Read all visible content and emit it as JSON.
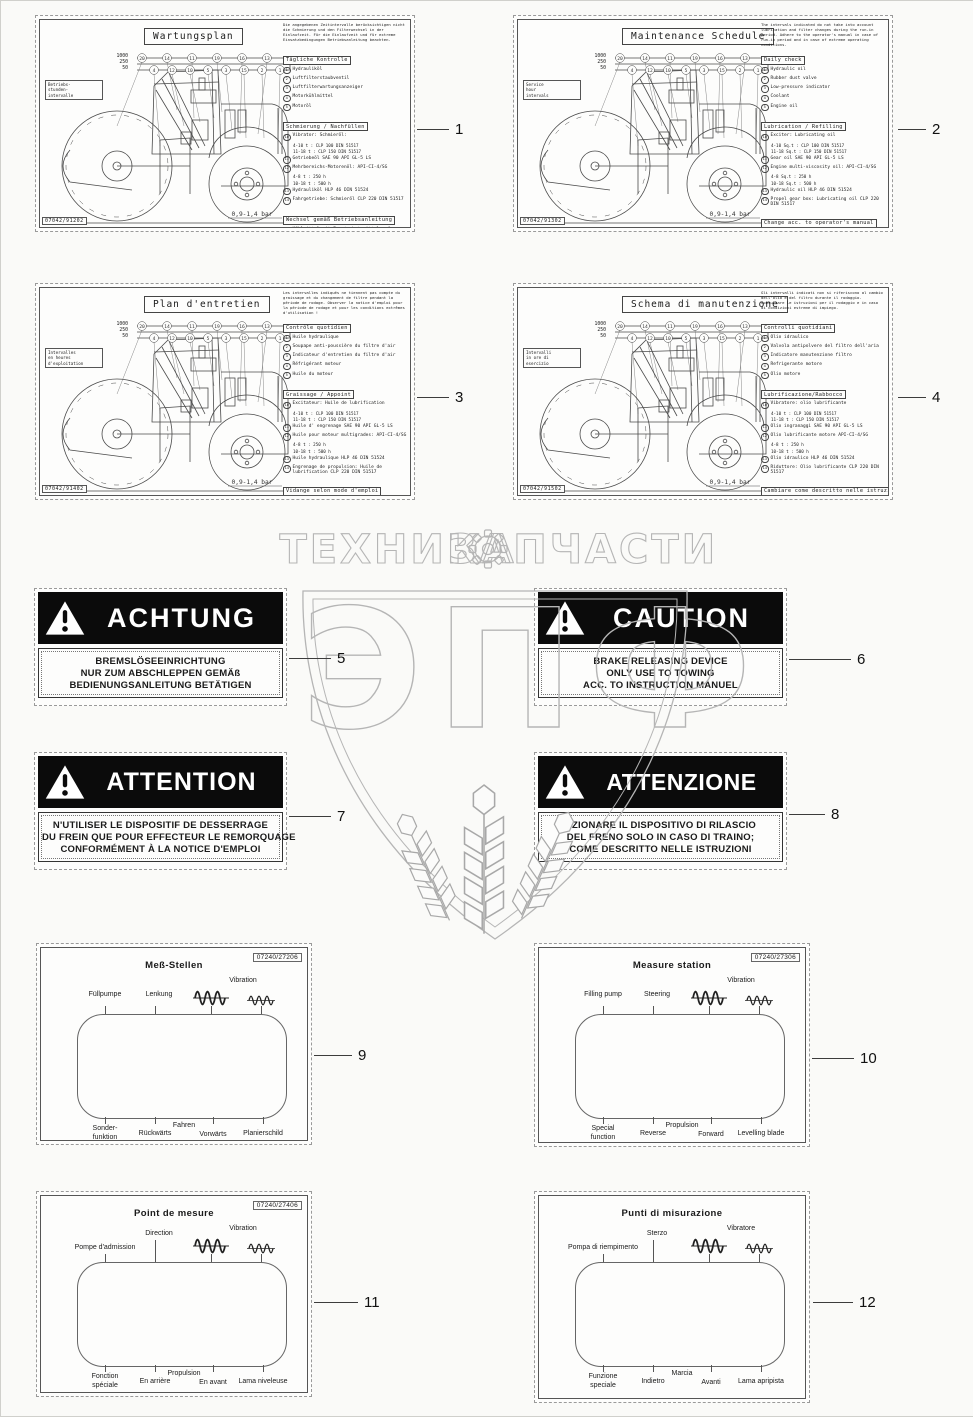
{
  "watermark": {
    "left_word": "ТЕХНИКА",
    "right_word": "ЗАПЧАСТИ",
    "monogram": "ЭПФ",
    "stroke_color": "#b5b5b5"
  },
  "machine": {
    "pressure": "0,9-1,4 bar",
    "hours": [
      "1000",
      "250",
      "50"
    ],
    "top_nums": [
      "20",
      "14",
      "11",
      "19",
      "16",
      "13"
    ],
    "bot_nums": [
      "4",
      "12",
      "10",
      "5",
      "3",
      "15",
      "2",
      "1"
    ]
  },
  "maintenance_labels": [
    {
      "callout": "1",
      "title": "Wartungsplan",
      "code": "07042/91202",
      "hours_label": "Betriebs-\nstunden-\nintervalle",
      "note": "Die angegebenen Zeitintervalle berücksichtigen nicht die Schmierung und den Filterwechsel in der Einlaufzeit. Für die Einlaufzeit und für extreme Einsatzbedingungen Betriebsanleitung beachten.",
      "sections": [
        {
          "heading": "Tägliche Kontrolle",
          "items": [
            {
              "n": "1",
              "t": "Hydrauliköl"
            },
            {
              "n": "2",
              "t": "Luftfilterstaubventil"
            },
            {
              "n": "3",
              "t": "Luftfilterwartungsanzeiger"
            },
            {
              "n": "4",
              "t": "Motorkühlmittel"
            },
            {
              "n": "5",
              "t": "Motoröl"
            }
          ]
        },
        {
          "heading": "Schmierung / Nachfüllen",
          "items": [
            {
              "n": "10",
              "t": "Vibrator: Schmieröl:",
              "sub": [
                "4-10 t : CLP 100 DIN 51517",
                "11-18 t : CLP 150 DIN 51517"
              ]
            },
            {
              "n": "11",
              "t": "Getriebeöl SAE 90 API GL-5 LS"
            },
            {
              "n": "12",
              "t": "Mehrbereichs-Motorenöl: API-CI-4/SG",
              "sub": [
                "4-8 t : 250 h",
                "10-18 t : 500 h"
              ]
            },
            {
              "n": "13",
              "t": "Hydrauliköl HLP 46 DIN 51524"
            },
            {
              "n": "14",
              "t": "Fahrgetriebe: Schmieröl CLP 220 DIN 51517"
            }
          ]
        },
        {
          "heading": "Wechsel gemäß Betriebsanleitung",
          "items": [
            {
              "n": "15",
              "t": "Kühlmittel mit Frostschutzmittel auf Äthylenglykolbasis"
            },
            {
              "n": "16",
              "t": "Hauptluftfilterpatrone und Sicherheitsluftfilterpatrone"
            },
            {
              "n": "17",
              "t": "Kraftstofffilter"
            },
            {
              "n": "18",
              "t": "Kraftstoffleitungsfilter"
            },
            {
              "n": "19",
              "t": "Motorölfilter"
            },
            {
              "n": "20",
              "t": "Hydraulikölfilter"
            }
          ]
        }
      ]
    },
    {
      "callout": "2",
      "title": "Maintenance Schedule",
      "code": "07042/91302",
      "hours_label": "Service\nhour\nintervals",
      "note": "The intervals indicated do not take into account lubrication and filter changes during the run-in period. Adhere to the operator's manual in case of run-in period and in case of extreme operating conditions.",
      "sections": [
        {
          "heading": "Daily check",
          "items": [
            {
              "n": "1",
              "t": "Hydraulic oil"
            },
            {
              "n": "2",
              "t": "Rubber dust valve"
            },
            {
              "n": "3",
              "t": "Low-pressure indicator"
            },
            {
              "n": "4",
              "t": "Coolant"
            },
            {
              "n": "5",
              "t": "Engine oil"
            }
          ]
        },
        {
          "heading": "Lubrication / Refilling",
          "items": [
            {
              "n": "10",
              "t": "Exciter: Lubricating oil",
              "sub": [
                "4-10 Sq.t : CLP 100 DIN 51517",
                "11-18 Sq.t : CLP 150 DIN 51517"
              ]
            },
            {
              "n": "11",
              "t": "Gear oil SAE 90 API GL-5 LS"
            },
            {
              "n": "12",
              "t": "Engine multi-viscosity oil: API-CI-4/SG",
              "sub": [
                "4-8 Sq.t : 250 h",
                "10-18 Sq.t : 500 h"
              ]
            },
            {
              "n": "13",
              "t": "Hydraulic oil HLP 46 DIN 51524"
            },
            {
              "n": "14",
              "t": "Propel gear box: Lubricating oil CLP 220 DIN 51517"
            }
          ]
        },
        {
          "heading": "Change acc. to operator's manual",
          "items": [
            {
              "n": "15",
              "t": "Coolant with ethylene-glycol-based antifreeze"
            },
            {
              "n": "16",
              "t": "Primary air cleaner element and secondary air cleaner element"
            },
            {
              "n": "17",
              "t": "Fuel filter"
            },
            {
              "n": "18",
              "t": "Fuel pipe filter"
            },
            {
              "n": "19",
              "t": "Engine oil filter"
            },
            {
              "n": "20",
              "t": "Hydraulic oil filter"
            }
          ]
        }
      ]
    },
    {
      "callout": "3",
      "title": "Plan d'entretien",
      "code": "07042/91402",
      "hours_label": "Intervalles\nen heures\nd'exploitation",
      "note": "Les intervalles indiqués ne tiennent pas compte du graissage et du changement de filtre pendant la période de rodage. Observer la notice d'emploi pour la période de rodage et pour les conditions extrêmes d'utilisation !",
      "sections": [
        {
          "heading": "Contrôle quotidien",
          "items": [
            {
              "n": "1",
              "t": "Huile hydraulique"
            },
            {
              "n": "2",
              "t": "Soupape anti-poussière du filtre d'air"
            },
            {
              "n": "3",
              "t": "Indicateur d'entretien du filtre d'air"
            },
            {
              "n": "4",
              "t": "Réfrigérant moteur"
            },
            {
              "n": "5",
              "t": "Huile du moteur"
            }
          ]
        },
        {
          "heading": "Graissage / Appoint",
          "items": [
            {
              "n": "10",
              "t": "Excitateur: Huile de lubrification",
              "sub": [
                "4-10 t : CLP 100 DIN 51517",
                "11-18 t : CLP 150 DIN 51517"
              ]
            },
            {
              "n": "11",
              "t": "Huile d' engrenage SAE 90 API GL-5 LS"
            },
            {
              "n": "12",
              "t": "Huile pour moteur multigrades: API-CI-4/SG",
              "sub": [
                "4-8 t : 250 h",
                "10-18 t : 500 h"
              ]
            },
            {
              "n": "13",
              "t": "Huile hydraulique HLP 46 DIN 51524"
            },
            {
              "n": "14",
              "t": "Engrenage de propulsion: Huile de lubrification CLP 220 DIN 51517"
            }
          ]
        },
        {
          "heading": "Vidange selon mode d'emploi",
          "items": [
            {
              "n": "15",
              "t": "Réfrigérant avec antigel à base de glycol d'éthylène"
            },
            {
              "n": "16",
              "t": "Cartouche du filtre d'air principal et cartouche du filtre d'air de sécurité"
            },
            {
              "n": "17",
              "t": "Filtre du carburant"
            },
            {
              "n": "18",
              "t": "Filtre de la conduite de carburant"
            },
            {
              "n": "19",
              "t": "Filtre d'huile du moteur"
            },
            {
              "n": "20",
              "t": "Filtre d'huile hydraulique"
            }
          ]
        }
      ]
    },
    {
      "callout": "4",
      "title": "Schema di manutenzione",
      "code": "07042/91502",
      "hours_label": "Intervalli\nin ore di\nesercizio",
      "note": "Gli intervalli indicati non si riferiscono al cambio dell'olio e del filtro durante il rodaggio. Consultare le istruzioni per il rodaggio e in caso di condizioni estreme di impiego.",
      "sections": [
        {
          "heading": "Controlli quotidiani",
          "items": [
            {
              "n": "1",
              "t": "Olio idraulico"
            },
            {
              "n": "2",
              "t": "Valvola antipolvere del filtro dell'aria"
            },
            {
              "n": "3",
              "t": "Indicatore manutenzione filtro"
            },
            {
              "n": "4",
              "t": "Refrigerante motore"
            },
            {
              "n": "5",
              "t": "Olio motore"
            }
          ]
        },
        {
          "heading": "Lubrificazione/Rabbocco",
          "items": [
            {
              "n": "10",
              "t": "Vibratore: olio lubrificante",
              "sub": [
                "4-10 t : CLP 100 DIN 51517",
                "11-18 t : CLP 150 DIN 51517"
              ]
            },
            {
              "n": "11",
              "t": "Olio ingranaggi SAE 90 API GL-5 LS"
            },
            {
              "n": "12",
              "t": "Olio lubrificante motore API-CI-4/SG",
              "sub": [
                "4-8 t : 250 h",
                "10-18 t : 500 h"
              ]
            },
            {
              "n": "13",
              "t": "Olio idraulico HLP 46 DIN 51524"
            },
            {
              "n": "14",
              "t": "Riduttore: Olio lubrificante CLP 220 DIN 51517"
            }
          ]
        },
        {
          "heading": "Cambiare come descritto nelle istruzioni",
          "items": [
            {
              "n": "15",
              "t": "Refrigerante con antigelo a base di etilenglicole"
            },
            {
              "n": "16",
              "t": "Cartuccia filtro principale e cartuccia filtro di sicurezza dell'aria"
            },
            {
              "n": "17",
              "t": "Filtro carburante"
            },
            {
              "n": "18",
              "t": "Filtro tubo carburante"
            },
            {
              "n": "19",
              "t": "Filtro olio motore"
            },
            {
              "n": "20",
              "t": "Filtro olio idraulico"
            }
          ]
        }
      ]
    }
  ],
  "warning_labels": [
    {
      "callout": "5",
      "word": "ACHTUNG",
      "lines": [
        "BREMSLÖSEEINRICHTUNG",
        "NUR ZUM ABSCHLEPPEN GEMÄß",
        "BEDIENUNGSANLEITUNG BETÄTIGEN"
      ]
    },
    {
      "callout": "6",
      "word": "CAUTION",
      "lines": [
        "BRAKE RELEASING DEVICE",
        "ONLY USE TO TOWING",
        "ACC. TO INSTRUCTION MANUEL"
      ]
    },
    {
      "callout": "7",
      "word": "ATTENTION",
      "lines": [
        "N'UTILISER LE DISPOSITIF DE DESSERRAGE",
        "DU FREIN QUE POUR EFFECTEUR LE REMORQUAGE",
        "CONFORMÉMENT À LA NOTICE D'EMPLOI"
      ]
    },
    {
      "callout": "8",
      "word": "ATTENZIONE",
      "lines": [
        "AZIONARE IL DISPOSITIVO DI RILASCIO",
        "DEL FRENO SOLO IN CASO DI TRAINO;",
        "COME DESCRITTO NELLE ISTRUZIONI"
      ]
    }
  ],
  "measure_labels": [
    {
      "callout": "9",
      "title": "Meß-Stellen",
      "code": "07240/27206",
      "top1": "Füllpumpe",
      "top2": "Lenkung",
      "vibration": "Vibration",
      "b1": "Sonder-\nfunktion",
      "b2": "Rückwärts",
      "group": "Fahren",
      "b3": "Vorwärts",
      "b4": "Planierschild"
    },
    {
      "callout": "10",
      "title": "Measure station",
      "code": "07240/27306",
      "top1": "Filling pump",
      "top2": "Steering",
      "vibration": "Vibration",
      "b1": "Special\nfunction",
      "b2": "Reverse",
      "group": "Propulsion",
      "b3": "Forward",
      "b4": "Levelling blade"
    },
    {
      "callout": "11",
      "title": "Point de mesure",
      "code": "07240/27406",
      "top1": "Pompe d'admission",
      "top2": "Direction",
      "vibration": "Vibration",
      "b1": "Fonction\nspéciale",
      "b2": "En arrière",
      "group": "Propulsion",
      "b3": "En avant",
      "b4": "Lama niveleuse"
    },
    {
      "callout": "12",
      "title": "Punti di misurazione",
      "code": "",
      "top1": "Pompa di riempimento",
      "top2": "Sterzo",
      "vibration": "Vibratore",
      "b1": "Funzione\nspeciale",
      "b2": "Indietro",
      "group": "Marcia",
      "b3": "Avanti",
      "b4": "Lama apripista"
    }
  ]
}
